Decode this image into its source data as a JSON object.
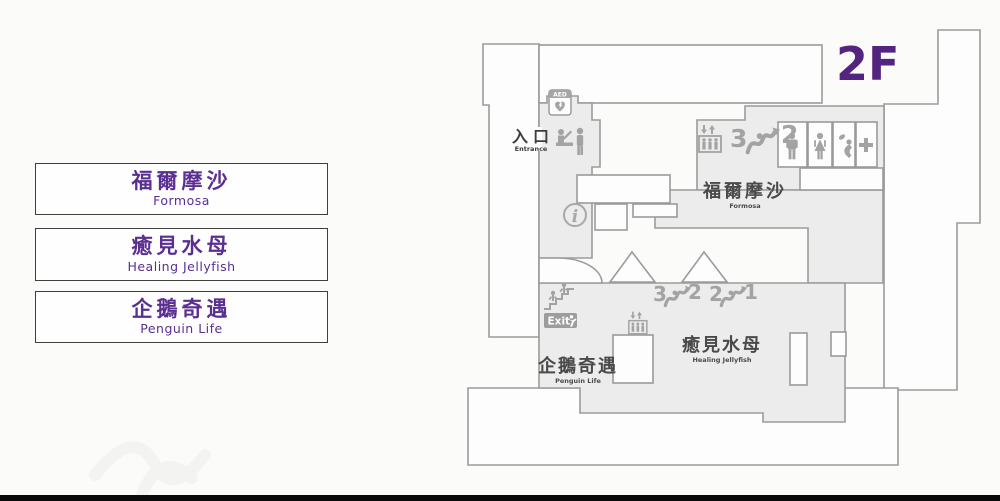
{
  "legend": {
    "items": [
      {
        "zh": "福爾摩沙",
        "en": "Formosa"
      },
      {
        "zh": "癒見水母",
        "en": "Healing Jellyfish"
      },
      {
        "zh": "企鵝奇遇",
        "en": "Penguin Life"
      }
    ]
  },
  "map": {
    "floor_label": "2F",
    "entrance_zh": "入口",
    "entrance_en": "Entrance",
    "aed_label": "AED",
    "exit_label": "Exit",
    "areas": {
      "formosa": {
        "zh": "福爾摩沙",
        "en": "Formosa"
      },
      "jellyfish": {
        "zh": "癒見水母",
        "en": "Healing Jellyfish"
      },
      "penguin": {
        "zh": "企鵝奇遇",
        "en": "Penguin Life"
      }
    },
    "escalators": {
      "north": {
        "from": "3",
        "to": "2"
      },
      "mid_left": {
        "from": "3",
        "to": "2"
      },
      "mid_right": {
        "from": "2",
        "to": "1"
      }
    },
    "icons": [
      "aed-icon",
      "entrance-counter-icon",
      "info-icon",
      "elevator-icon",
      "escalator-icon",
      "mens-restroom-icon",
      "womens-restroom-icon",
      "baby-care-icon",
      "first-aid-icon",
      "stairs-icon",
      "exit-runner-icon"
    ]
  },
  "colors": {
    "accent_purple": "#5b2f91",
    "floor_purple": "#53257f",
    "wall_gray": "#9b9b9b",
    "area_fill": "#ececec",
    "icon_gray": "#a3a3a3",
    "label_dark": "#4a4a4a"
  }
}
